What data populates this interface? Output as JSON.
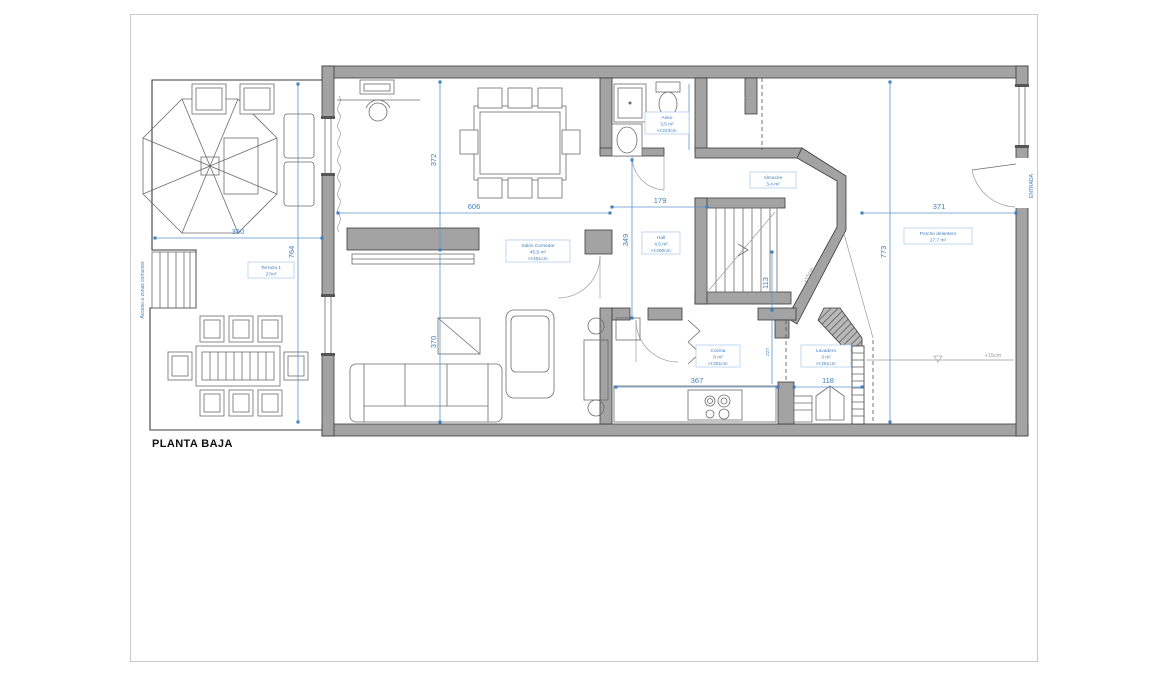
{
  "title": "PLANTA BAJA",
  "rooms": {
    "terraza": {
      "name": "Terraza 1",
      "area": "27m²"
    },
    "salon": {
      "name": "Salón Comedor",
      "area": "45,5 m²",
      "height": "H:251cm"
    },
    "aseo": {
      "name": "Aseo",
      "area": "3,5 m²",
      "height": "H:223cm"
    },
    "hall": {
      "name": "Hall",
      "area": "4,5 m²",
      "height": "H:200cm"
    },
    "almacen": {
      "name": "Almacén",
      "area": "3,4 m²"
    },
    "cocina": {
      "name": "Cocina",
      "area": "8 m²",
      "height": "H:251cm"
    },
    "lavadero": {
      "name": "Lavadero",
      "area": "3 m²",
      "height": "H:251cm"
    },
    "porche": {
      "name": "Porche delantero",
      "area": "27,7 m²"
    }
  },
  "dimensions": {
    "terraza_width": "350",
    "terraza_height": "764",
    "salon_width": "606",
    "salon_depth_top": "372",
    "salon_depth_bottom": "370",
    "hall_width": "179",
    "hall_depth": "349",
    "aseo_interior": "171",
    "pasillo_depth": "113",
    "cocina_depth": "227",
    "cocina_width": "367",
    "lavadero_width": "118",
    "porche_width": "371",
    "porche_height": "773"
  },
  "annotations": {
    "acceso": "Acceso a zonas comunes",
    "entrada": "ENTRADA",
    "nivel": "+15cm"
  },
  "colors": {
    "dimension_blue": "#3f7fc1",
    "wall_gray": "#a3a3a3"
  }
}
